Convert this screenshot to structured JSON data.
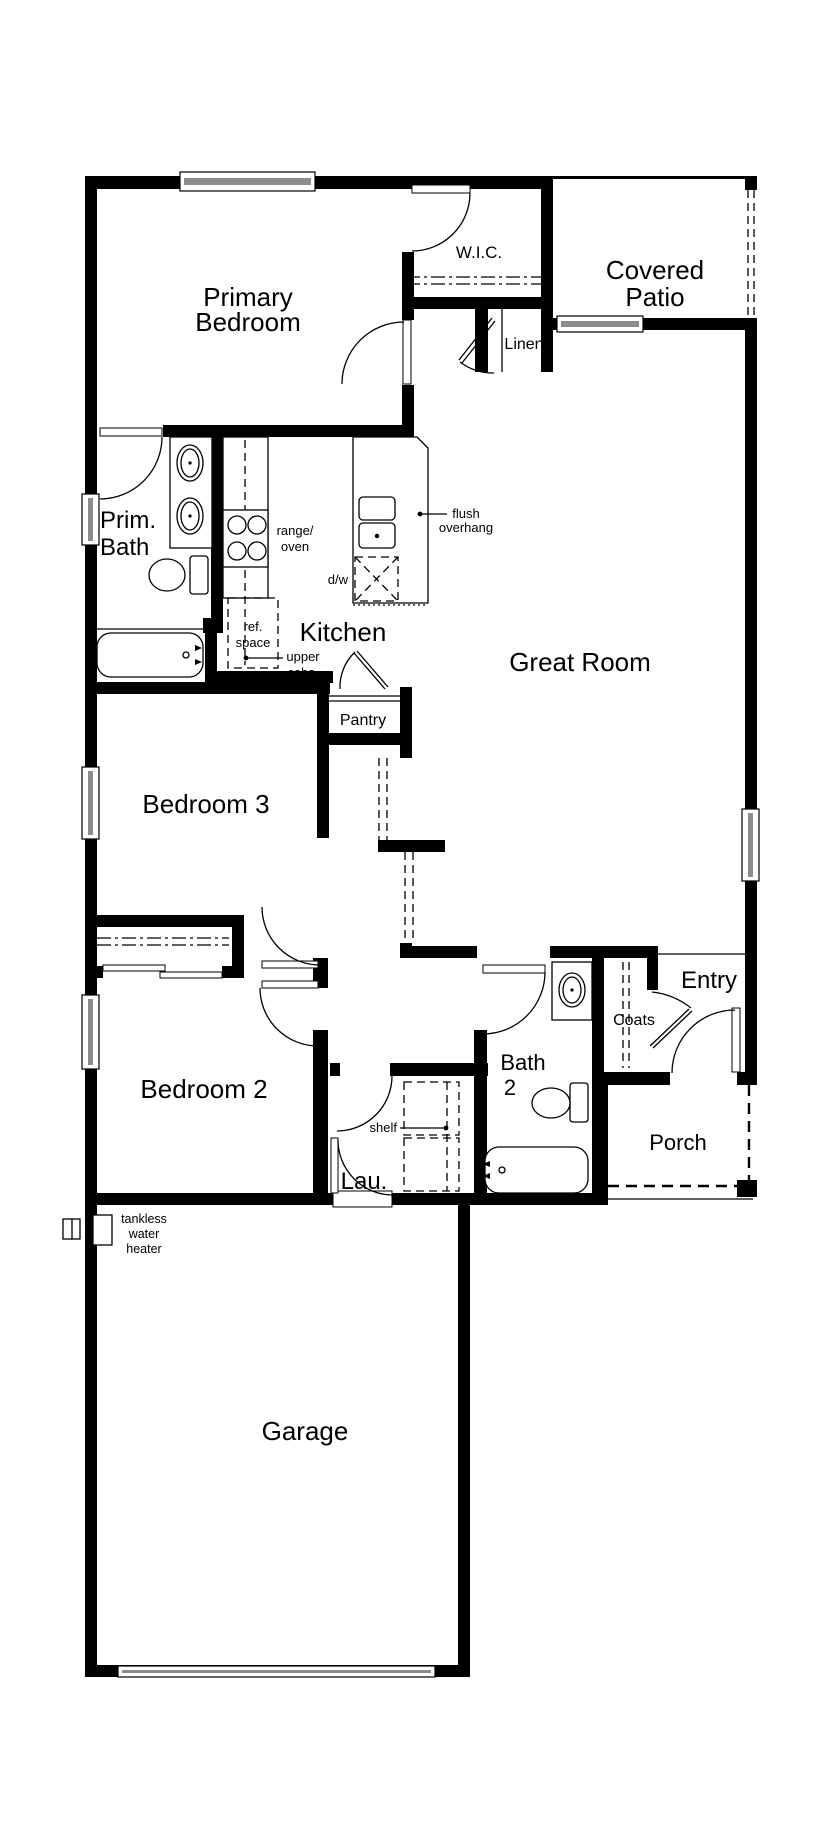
{
  "rooms": {
    "primary_bedroom": [
      "Primary",
      "Bedroom"
    ],
    "wic": "W.I.C.",
    "covered_patio": [
      "Covered",
      "Patio"
    ],
    "linen": "Linen",
    "prim_bath": [
      "Prim.",
      "Bath"
    ],
    "kitchen": "Kitchen",
    "great_room": "Great Room",
    "pantry": "Pantry",
    "bedroom3": "Bedroom 3",
    "bedroom2": "Bedroom 2",
    "bath2": [
      "Bath",
      "2"
    ],
    "entry": "Entry",
    "coats": "Coats",
    "porch": "Porch",
    "laundry": "Lau.",
    "garage": "Garage"
  },
  "annotations": {
    "range_oven": [
      "range/",
      "oven"
    ],
    "flush_overhang": [
      "flush",
      "overhang"
    ],
    "dw": "d/w",
    "ref_space": [
      "ref.",
      "space"
    ],
    "upper_cabs": [
      "upper",
      "cabs."
    ],
    "shelf": "shelf",
    "tankless": [
      "tankless",
      "water",
      "heater"
    ]
  },
  "colors": {
    "wall": "#000000",
    "window_fill": "#8c8c8c",
    "background": "#ffffff"
  }
}
